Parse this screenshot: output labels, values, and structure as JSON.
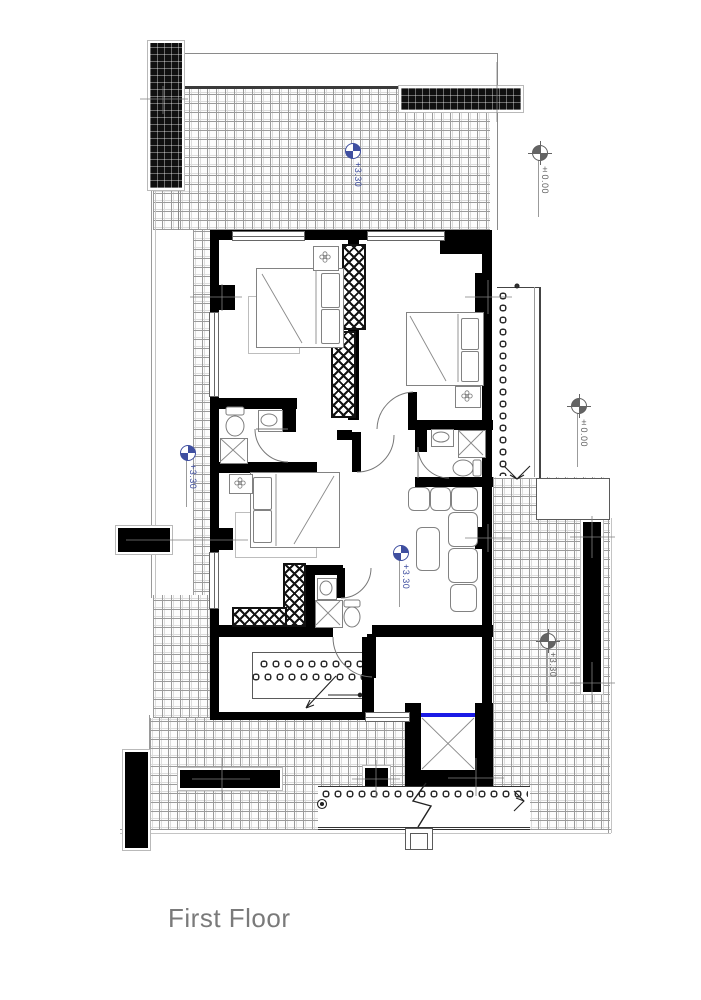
{
  "title": "First Floor",
  "markers": {
    "terrace_top": {
      "value": "+3.30"
    },
    "site_ne": {
      "value": "±0.00"
    },
    "site_e": {
      "value": "±0.00"
    },
    "terrace_w": {
      "value": "+3.30"
    },
    "living": {
      "value": "+3.30"
    },
    "terrace_se": {
      "value": "+3.30"
    }
  },
  "colors": {
    "marker_blue": "#3f4fa0",
    "marker_gray": "#646464",
    "elevator_line_blue": "#1a1ae6",
    "wall_black": "#000000",
    "hatch_line_gray": "#9b9b9b",
    "title_gray": "#7a7a7a"
  }
}
